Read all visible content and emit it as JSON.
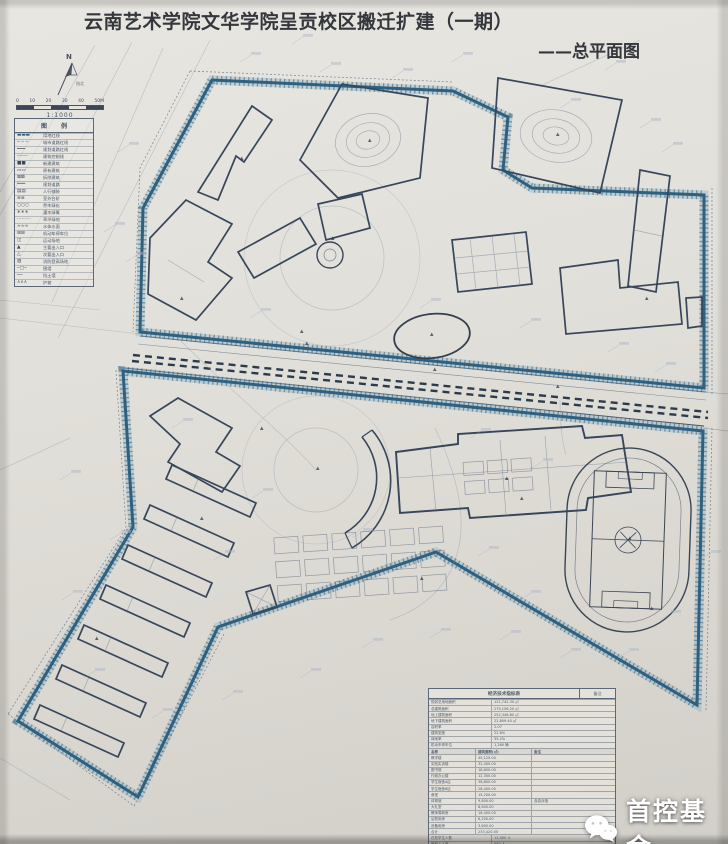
{
  "title": "云南艺术学院文华学院呈贡校区搬迁扩建（一期）",
  "subtitle": "——总平面图",
  "north": {
    "label": "N",
    "caption": "指北"
  },
  "scale": {
    "ticks": [
      "0",
      "10",
      "20",
      "30",
      "40",
      "50M"
    ],
    "ratio": "1:1000"
  },
  "legend": {
    "title": "图 例",
    "items": [
      {
        "glyph": "▬▬▬",
        "color": "#2e6181",
        "label": "用地红线"
      },
      {
        "glyph": "─ ─ ─",
        "color": "#4a5668",
        "label": "城市道路红线"
      },
      {
        "glyph": "━━━",
        "color": "#4a5668",
        "label": "规划道路红线"
      },
      {
        "glyph": "╌╌╌╌",
        "color": "#4a5668",
        "label": "建筑控制线"
      },
      {
        "glyph": "■■",
        "color": "#3a4656",
        "label": "新建建筑"
      },
      {
        "glyph": "▭▭",
        "color": "#3a4656",
        "label": "原有建筑"
      },
      {
        "glyph": "⊠⊠",
        "color": "#3a4656",
        "label": "拆除建筑"
      },
      {
        "glyph": "═══",
        "color": "#4a5668",
        "label": "规划道路"
      },
      {
        "glyph": "▤▤",
        "color": "#4a5668",
        "label": "人行铺装"
      },
      {
        "glyph": "≣≣",
        "color": "#4a5668",
        "label": "室外台阶"
      },
      {
        "glyph": "○○○",
        "color": "#4a5668",
        "label": "乔木绿化"
      },
      {
        "glyph": "∗∗∗",
        "color": "#4a5668",
        "label": "灌木绿篱"
      },
      {
        "glyph": "⋯⋯⋯",
        "color": "#4a5668",
        "label": "草坪绿地"
      },
      {
        "glyph": "≈≈≈",
        "color": "#4a5668",
        "label": "水体水面"
      },
      {
        "glyph": "⊞⊞",
        "color": "#4a5668",
        "label": "机动车停车位"
      },
      {
        "glyph": "◫",
        "color": "#4a5668",
        "label": "运动场地"
      },
      {
        "glyph": "▲",
        "color": "#3a4656",
        "label": "主要出入口"
      },
      {
        "glyph": "△",
        "color": "#3a4656",
        "label": "次要出入口"
      },
      {
        "glyph": "▨",
        "color": "#4a5668",
        "label": "消防登高场地"
      },
      {
        "glyph": "─□─",
        "color": "#4a5668",
        "label": "围墙"
      },
      {
        "glyph": "┉┉",
        "color": "#4a5668",
        "label": "挡土墙"
      },
      {
        "glyph": "∧∧∧",
        "color": "#4a5668",
        "label": "护坡"
      }
    ]
  },
  "table": {
    "title": "经济技术指标表",
    "note_header": "备注",
    "top_rows": [
      [
        "规划总用地面积",
        "121,742.30 ㎡"
      ],
      [
        "总建筑面积",
        "275,156.20 ㎡"
      ],
      [
        "地上建筑面积",
        "252,346.80 ㎡"
      ],
      [
        "地下建筑面积",
        "22,809.40 ㎡"
      ],
      [
        "容积率",
        "2.07"
      ],
      [
        "建筑密度",
        "22.6%"
      ],
      [
        "绿地率",
        "35.2%"
      ],
      [
        "机动车停车位",
        "1,260 辆"
      ]
    ],
    "mid_header": [
      "名称",
      "建筑面积(㎡)",
      "备注"
    ],
    "mid_rows": [
      [
        "教学楼",
        "45,120.00",
        ""
      ],
      [
        "实验实训楼",
        "32,400.00",
        ""
      ],
      [
        "图书馆",
        "18,600.00",
        ""
      ],
      [
        "行政办公楼",
        "12,300.00",
        ""
      ],
      [
        "学生宿舍A区",
        "36,800.00",
        ""
      ],
      [
        "学生宿舍B区",
        "28,400.00",
        ""
      ],
      [
        "食堂",
        "15,200.00",
        ""
      ],
      [
        "体育馆",
        "9,800.00",
        "含游泳馆"
      ],
      [
        "大礼堂",
        "8,600.00",
        ""
      ],
      [
        "教师周转房",
        "16,400.00",
        ""
      ],
      [
        "后勤用房",
        "6,200.00",
        ""
      ],
      [
        "设备用房",
        "3,600.00",
        ""
      ],
      [
        "合计",
        "233,420.00",
        ""
      ]
    ],
    "bottom_rows": [
      [
        "在校学生人数",
        "12,000 人"
      ],
      [
        "教职工人数",
        "860 人"
      ],
      [
        "学生床位数",
        "11,200 床"
      ],
      [
        "非机动车停车位",
        "3,000 辆"
      ],
      [
        "备注",
        "本图所注尺寸均以米为单位"
      ]
    ]
  },
  "watermark": {
    "icon": "wechat-icon",
    "text": "首控基金"
  },
  "colors": {
    "paper": "#e2e0da",
    "line": "#3f4e63",
    "boundary": "#2e6181",
    "faint": "#8a93a6",
    "title_text": "#34373c",
    "watermark_text": "#ffffff"
  }
}
